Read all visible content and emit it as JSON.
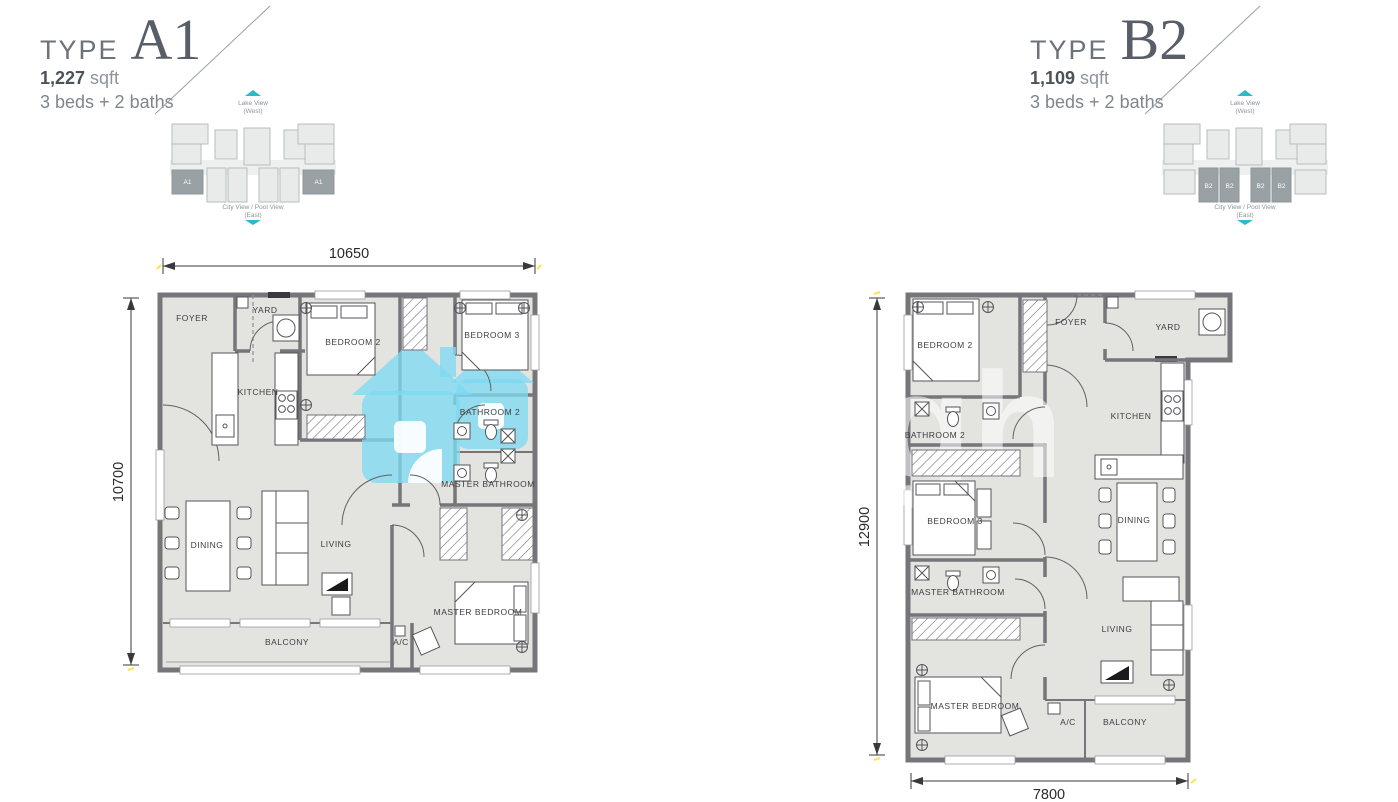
{
  "sheet": {
    "background": "#ffffff"
  },
  "colors": {
    "wall": "#75757a",
    "floor": "#e3e3e0",
    "accent_teal": "#2fb9c6",
    "watermark_blue": "#7edaf2",
    "highlight_block": "#9aa1a5",
    "title_gray": "#575e68",
    "dim_marker_yellow": "#ffe34d"
  },
  "units": [
    {
      "id": "A1",
      "header": {
        "type_word": "TYPE",
        "type_code": "A1",
        "area_value": "1,227",
        "area_unit": "sqft",
        "config": "3 beds + 2 baths"
      },
      "site": {
        "top_view": "Lake View",
        "top_view_sub": "(West)",
        "bottom_view": "City View / Pool View",
        "bottom_view_sub": "(East)",
        "highlight": "ends",
        "unit_labels": [
          "A1",
          "A1"
        ]
      },
      "dimensions": {
        "top": "10650",
        "left": "10700"
      },
      "rooms": {
        "foyer": "FOYER",
        "yard": "YARD",
        "kitchen": "KITCHEN",
        "bedroom2": "BEDROOM 2",
        "bedroom3": "BEDROOM 3",
        "bathroom2": "BATHROOM 2",
        "master_bathroom": "MASTER BATHROOM",
        "dining": "DINING",
        "living": "LIVING",
        "master_bedroom": "MASTER BEDROOM",
        "balcony": "BALCONY",
        "ac": "A/C"
      }
    },
    {
      "id": "B2",
      "header": {
        "type_word": "TYPE",
        "type_code": "B2",
        "area_value": "1,109",
        "area_unit": "sqft",
        "config": "3 beds + 2 baths"
      },
      "site": {
        "top_view": "Lake View",
        "top_view_sub": "(West)",
        "bottom_view": "City View / Pool View",
        "bottom_view_sub": "(East)",
        "highlight": "middle",
        "unit_labels": [
          "B2",
          "B2",
          "B2",
          "B2"
        ]
      },
      "dimensions": {
        "left": "12900",
        "bottom": "7800"
      },
      "rooms": {
        "foyer": "FOYER",
        "yard": "YARD",
        "kitchen": "KITCHEN",
        "bedroom2": "BEDROOM 2",
        "bedroom3": "BEDROOM 3",
        "bathroom2": "BATHROOM 2",
        "master_bathroom": "MASTER BATHROOM",
        "dining": "DINING",
        "living": "LIVING",
        "master_bedroom": "MASTER BEDROOM",
        "balcony": "BALCONY",
        "ac": "A/C"
      }
    }
  ],
  "watermark": {
    "gh_text": "gh"
  }
}
